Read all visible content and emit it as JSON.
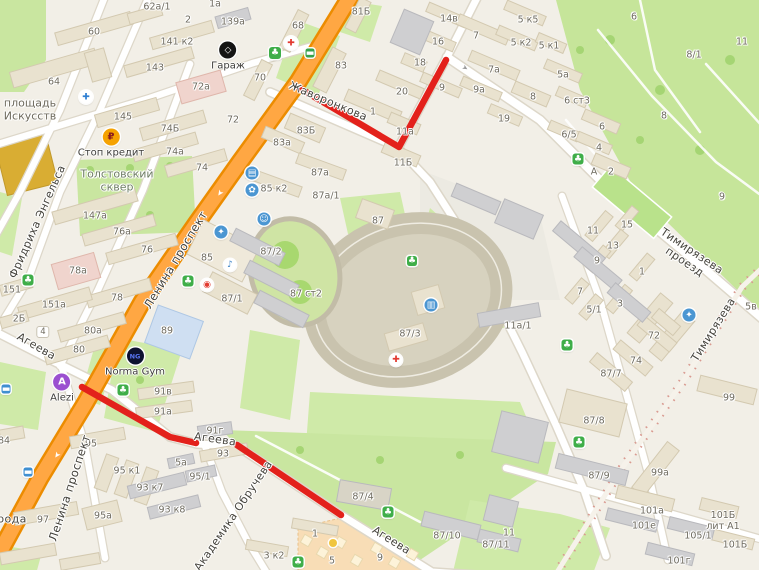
{
  "map": {
    "route_color": "#e3211b",
    "road_color": "#ffa743",
    "street_labels": [
      {
        "t": "Фридриха Энгельса",
        "x": 38,
        "y": 222,
        "r": -66,
        "s": 11
      },
      {
        "t": "Ленина проспект",
        "x": 176,
        "y": 260,
        "r": -59,
        "s": 11.5
      },
      {
        "t": "Ленина проспект",
        "x": 70,
        "y": 488,
        "r": -72,
        "s": 11.5
      },
      {
        "t": "Жаворонкова",
        "x": 328,
        "y": 102,
        "r": 23,
        "s": 11
      },
      {
        "t": "Тимирязева проезд",
        "x": 688,
        "y": 257,
        "r": 34,
        "s": 11
      },
      {
        "t": "Тимирязева",
        "x": 714,
        "y": 330,
        "r": -58,
        "s": 11
      },
      {
        "t": "Агеева",
        "x": 36,
        "y": 347,
        "r": 30,
        "s": 11
      },
      {
        "t": "Агеева",
        "x": 215,
        "y": 440,
        "r": 8,
        "s": 11
      },
      {
        "t": "Агеева",
        "x": 391,
        "y": 541,
        "r": 32,
        "s": 11
      },
      {
        "t": "Академика Обручева",
        "x": 234,
        "y": 516,
        "r": -56,
        "s": 11
      },
      {
        "t": "рода",
        "x": 12,
        "y": 520,
        "r": 0,
        "s": 11
      }
    ],
    "area_labels": [
      {
        "t": "площадь\nИскусств",
        "x": 30,
        "y": 110,
        "c": "#6d695c"
      },
      {
        "t": "Толстовский\nсквер",
        "x": 117,
        "y": 181,
        "c": "#6e7d64"
      }
    ],
    "building_labels": [
      {
        "t": "62а/1",
        "x": 157,
        "y": 8
      },
      {
        "t": "1а",
        "x": 215,
        "y": 5
      },
      {
        "t": "2",
        "x": 188,
        "y": 21
      },
      {
        "t": "139а",
        "x": 233,
        "y": 23
      },
      {
        "t": "60",
        "x": 94,
        "y": 33
      },
      {
        "t": "141 к2",
        "x": 177,
        "y": 43
      },
      {
        "t": "143",
        "x": 155,
        "y": 69
      },
      {
        "t": "64",
        "x": 54,
        "y": 83
      },
      {
        "t": "72а",
        "x": 201,
        "y": 88
      },
      {
        "t": "145",
        "x": 123,
        "y": 118
      },
      {
        "t": "72",
        "x": 233,
        "y": 121
      },
      {
        "t": "74Б",
        "x": 170,
        "y": 130
      },
      {
        "t": "74а",
        "x": 175,
        "y": 153
      },
      {
        "t": "74",
        "x": 202,
        "y": 169
      },
      {
        "t": "81Б",
        "x": 361,
        "y": 13
      },
      {
        "t": "68",
        "x": 298,
        "y": 27
      },
      {
        "t": "70",
        "x": 260,
        "y": 79
      },
      {
        "t": "83",
        "x": 341,
        "y": 67
      },
      {
        "t": "18",
        "x": 420,
        "y": 64
      },
      {
        "t": "20",
        "x": 402,
        "y": 93
      },
      {
        "t": "1",
        "x": 373,
        "y": 113
      },
      {
        "t": "83Б",
        "x": 306,
        "y": 132
      },
      {
        "t": "83а",
        "x": 282,
        "y": 144
      },
      {
        "t": "87а",
        "x": 320,
        "y": 174
      },
      {
        "t": "11а",
        "x": 405,
        "y": 133
      },
      {
        "t": "11Б",
        "x": 403,
        "y": 164
      },
      {
        "t": "14в",
        "x": 449,
        "y": 20
      },
      {
        "t": "16",
        "x": 438,
        "y": 43
      },
      {
        "t": "7",
        "x": 476,
        "y": 37
      },
      {
        "t": "7а",
        "x": 494,
        "y": 71
      },
      {
        "t": "9",
        "x": 442,
        "y": 89
      },
      {
        "t": "9а",
        "x": 479,
        "y": 91
      },
      {
        "t": "19",
        "x": 504,
        "y": 120
      },
      {
        "t": "5 к5",
        "x": 528,
        "y": 21
      },
      {
        "t": "5 к2",
        "x": 521,
        "y": 44
      },
      {
        "t": "5 к1",
        "x": 549,
        "y": 47
      },
      {
        "t": "5а",
        "x": 563,
        "y": 76
      },
      {
        "t": "8",
        "x": 533,
        "y": 98
      },
      {
        "t": "6 ст3",
        "x": 577,
        "y": 102
      },
      {
        "t": "6/5",
        "x": 569,
        "y": 136
      },
      {
        "t": "6",
        "x": 602,
        "y": 128
      },
      {
        "t": "4",
        "x": 599,
        "y": 149
      },
      {
        "t": "А",
        "x": 594,
        "y": 173
      },
      {
        "t": "2",
        "x": 611,
        "y": 173
      },
      {
        "t": "6",
        "x": 634,
        "y": 18
      },
      {
        "t": "8/1",
        "x": 694,
        "y": 56
      },
      {
        "t": "11",
        "x": 742,
        "y": 43
      },
      {
        "t": "8",
        "x": 664,
        "y": 117
      },
      {
        "t": "9",
        "x": 722,
        "y": 198
      },
      {
        "t": "85 к2",
        "x": 274,
        "y": 190
      },
      {
        "t": "87а/1",
        "x": 326,
        "y": 197
      },
      {
        "t": "87",
        "x": 378,
        "y": 222
      },
      {
        "t": "147а",
        "x": 95,
        "y": 217
      },
      {
        "t": "76а",
        "x": 122,
        "y": 233
      },
      {
        "t": "76",
        "x": 147,
        "y": 251
      },
      {
        "t": "78а",
        "x": 78,
        "y": 272
      },
      {
        "t": "151",
        "x": 12,
        "y": 291
      },
      {
        "t": "78",
        "x": 117,
        "y": 299
      },
      {
        "t": "151а",
        "x": 54,
        "y": 306
      },
      {
        "t": "2Б",
        "x": 19,
        "y": 320
      },
      {
        "t": "80а",
        "x": 93,
        "y": 332
      },
      {
        "t": "80",
        "x": 79,
        "y": 351
      },
      {
        "t": "85",
        "x": 207,
        "y": 259
      },
      {
        "t": "87/1",
        "x": 232,
        "y": 300
      },
      {
        "t": "89",
        "x": 167,
        "y": 332
      },
      {
        "t": "87/2",
        "x": 271,
        "y": 253
      },
      {
        "t": "87 ст2",
        "x": 306,
        "y": 295
      },
      {
        "t": "87/3",
        "x": 410,
        "y": 335
      },
      {
        "t": "15",
        "x": 627,
        "y": 226
      },
      {
        "t": "11",
        "x": 593,
        "y": 232
      },
      {
        "t": "13",
        "x": 613,
        "y": 247
      },
      {
        "t": "9",
        "x": 597,
        "y": 262
      },
      {
        "t": "1",
        "x": 642,
        "y": 273
      },
      {
        "t": "7",
        "x": 580,
        "y": 293
      },
      {
        "t": "3",
        "x": 620,
        "y": 305
      },
      {
        "t": "5/1",
        "x": 594,
        "y": 311
      },
      {
        "t": "11а/1",
        "x": 518,
        "y": 327
      },
      {
        "t": "5в",
        "x": 751,
        "y": 308
      },
      {
        "t": "72",
        "x": 654,
        "y": 337
      },
      {
        "t": "74",
        "x": 636,
        "y": 362
      },
      {
        "t": "87/7",
        "x": 611,
        "y": 375
      },
      {
        "t": "91в",
        "x": 163,
        "y": 393
      },
      {
        "t": "91а",
        "x": 163,
        "y": 413
      },
      {
        "t": "95",
        "x": 91,
        "y": 445
      },
      {
        "t": "93",
        "x": 223,
        "y": 455
      },
      {
        "t": "5а",
        "x": 181,
        "y": 464
      },
      {
        "t": "95 к1",
        "x": 127,
        "y": 472
      },
      {
        "t": "95/1",
        "x": 200,
        "y": 478
      },
      {
        "t": "93 к7",
        "x": 150,
        "y": 489
      },
      {
        "t": "93 к8",
        "x": 172,
        "y": 511
      },
      {
        "t": "95а",
        "x": 103,
        "y": 517
      },
      {
        "t": "97",
        "x": 43,
        "y": 521
      },
      {
        "t": "84",
        "x": 4,
        "y": 442
      },
      {
        "t": "91г",
        "x": 215,
        "y": 432
      },
      {
        "t": "87/4",
        "x": 363,
        "y": 498
      },
      {
        "t": "87/10",
        "x": 447,
        "y": 537
      },
      {
        "t": "87/11",
        "x": 496,
        "y": 546
      },
      {
        "t": "1",
        "x": 315,
        "y": 535
      },
      {
        "t": "3 к2",
        "x": 274,
        "y": 557
      },
      {
        "t": "5",
        "x": 332,
        "y": 562
      },
      {
        "t": "9",
        "x": 380,
        "y": 559
      },
      {
        "t": "87/8",
        "x": 594,
        "y": 422
      },
      {
        "t": "87/9",
        "x": 599,
        "y": 477
      },
      {
        "t": "99",
        "x": 729,
        "y": 399
      },
      {
        "t": "99а",
        "x": 660,
        "y": 474
      },
      {
        "t": "101а",
        "x": 652,
        "y": 512
      },
      {
        "t": "101Б лит А1",
        "x": 723,
        "y": 522
      },
      {
        "t": "101е",
        "x": 644,
        "y": 527
      },
      {
        "t": "105/1",
        "x": 698,
        "y": 537
      },
      {
        "t": "101Б",
        "x": 735,
        "y": 546
      },
      {
        "t": "101г",
        "x": 679,
        "y": 562
      },
      {
        "t": "11",
        "x": 509,
        "y": 534
      }
    ],
    "badge": {
      "t": "4",
      "x": 43,
      "y": 332
    },
    "pois": [
      {
        "name": "garage",
        "g": "◇",
        "label": "Гараж",
        "x": 228,
        "y": 50,
        "bg": "#141414",
        "fg": "#ffffff",
        "size": 17,
        "gs": 9
      },
      {
        "name": "stop-credit",
        "g": "₽",
        "label": "Стоп кредит",
        "x": 111,
        "y": 137,
        "bg": "#f5a201",
        "fg": "#8c1d1d",
        "size": 17,
        "gs": 10
      },
      {
        "name": "norma-gym",
        "g": "NG",
        "label": "Norma Gym",
        "x": 135,
        "y": 356,
        "bg": "#0d1230",
        "fg": "#5874f2",
        "size": 17,
        "gs": 6.5
      },
      {
        "name": "alezi",
        "g": "A",
        "label": "Alezi",
        "x": 62,
        "y": 382,
        "bg": "#9b4fd0",
        "fg": "#ffffff",
        "size": 17,
        "gs": 10
      }
    ],
    "small_pois": [
      {
        "name": "hospital",
        "g": "✚",
        "x": 86,
        "y": 97,
        "bg": "#ffffff",
        "fg": "#2f7fd2",
        "size": 13
      },
      {
        "name": "pharmacy",
        "g": "✚",
        "x": 291,
        "y": 43,
        "bg": "#ffffff",
        "fg": "#e23b31",
        "size": 13
      },
      {
        "name": "medical",
        "g": "✚",
        "x": 396,
        "y": 360,
        "bg": "#ffffff",
        "fg": "#e23b31",
        "size": 12
      },
      {
        "name": "photo",
        "g": "◉",
        "x": 207,
        "y": 285,
        "bg": "#ffffff",
        "fg": "#e23b31",
        "size": 12
      },
      {
        "name": "music",
        "g": "♪",
        "x": 230,
        "y": 265,
        "bg": "#ffffff",
        "fg": "#3b82c6",
        "size": 12
      },
      {
        "name": "education",
        "g": "✦",
        "x": 221,
        "y": 232,
        "bg": "#4b96d2",
        "fg": "#ffffff",
        "size": 13
      },
      {
        "name": "theatre",
        "g": "☺",
        "x": 264,
        "y": 219,
        "bg": "#4b96d2",
        "fg": "#ffffff",
        "size": 13
      },
      {
        "name": "shop",
        "g": "▤",
        "x": 252,
        "y": 173,
        "bg": "#4b96d2",
        "fg": "#ffffff",
        "size": 13
      },
      {
        "name": "flowers",
        "g": "✿",
        "x": 252,
        "y": 190,
        "bg": "#4b96d2",
        "fg": "#ffffff",
        "size": 13
      },
      {
        "name": "museum",
        "g": "▥",
        "x": 431,
        "y": 305,
        "bg": "#4b96d2",
        "fg": "#ffffff",
        "size": 13
      },
      {
        "name": "school",
        "g": "✦",
        "x": 689,
        "y": 315,
        "bg": "#4b96d2",
        "fg": "#ffffff",
        "size": 13
      },
      {
        "name": "park",
        "g": "♣",
        "x": 275,
        "y": 53,
        "bg": "#3fae49",
        "fg": "#ffffff",
        "size": 12,
        "sq": 1
      },
      {
        "name": "park",
        "g": "♣",
        "x": 188,
        "y": 281,
        "bg": "#3fae49",
        "fg": "#ffffff",
        "size": 11,
        "sq": 1
      },
      {
        "name": "park",
        "g": "♣",
        "x": 578,
        "y": 159,
        "bg": "#3fae49",
        "fg": "#ffffff",
        "size": 11,
        "sq": 1
      },
      {
        "name": "park",
        "g": "♣",
        "x": 567,
        "y": 345,
        "bg": "#3fae49",
        "fg": "#ffffff",
        "size": 11,
        "sq": 1
      },
      {
        "name": "park",
        "g": "♣",
        "x": 579,
        "y": 442,
        "bg": "#3fae49",
        "fg": "#ffffff",
        "size": 11,
        "sq": 1
      },
      {
        "name": "park",
        "g": "♣",
        "x": 388,
        "y": 512,
        "bg": "#3fae49",
        "fg": "#ffffff",
        "size": 11,
        "sq": 1
      },
      {
        "name": "park",
        "g": "♣",
        "x": 123,
        "y": 390,
        "bg": "#3fae49",
        "fg": "#ffffff",
        "size": 11,
        "sq": 1
      },
      {
        "name": "park",
        "g": "♣",
        "x": 298,
        "y": 562,
        "bg": "#3fae49",
        "fg": "#ffffff",
        "size": 11,
        "sq": 1
      },
      {
        "name": "park",
        "g": "♣",
        "x": 28,
        "y": 280,
        "bg": "#3fae49",
        "fg": "#ffffff",
        "size": 11,
        "sq": 1
      },
      {
        "name": "park",
        "g": "♣",
        "x": 412,
        "y": 261,
        "bg": "#3fae49",
        "fg": "#ffffff",
        "size": 10,
        "sq": 1
      },
      {
        "name": "transit-stop",
        "g": "▬",
        "x": 310,
        "y": 53,
        "bg": "#35a24c",
        "fg": "#ffffff",
        "size": 9,
        "sq": 1
      },
      {
        "name": "transit-stop",
        "g": "▬",
        "x": 28,
        "y": 472,
        "bg": "#3f8fd1",
        "fg": "#ffffff",
        "size": 9,
        "sq": 1
      },
      {
        "name": "transit-stop",
        "g": "▬",
        "x": 6,
        "y": 389,
        "bg": "#3f8fd1",
        "fg": "#ffffff",
        "size": 9,
        "sq": 1
      },
      {
        "name": "point",
        "g": "",
        "x": 333,
        "y": 543,
        "bg": "#f0c53e",
        "fg": "#ffffff",
        "size": 8
      }
    ],
    "markers": [
      {
        "t": "➤",
        "x": 266,
        "y": 73,
        "r": -55,
        "c": "#ffffff",
        "s": 8
      },
      {
        "t": "➤",
        "x": 220,
        "y": 193,
        "r": 125,
        "c": "#ffffff",
        "s": 8
      },
      {
        "t": "➤",
        "x": 57,
        "y": 455,
        "r": 125,
        "c": "#ffffff",
        "s": 8
      },
      {
        "t": "➤",
        "x": 465,
        "y": 68,
        "r": 32,
        "c": "#9a9a9a",
        "s": 7
      }
    ]
  }
}
